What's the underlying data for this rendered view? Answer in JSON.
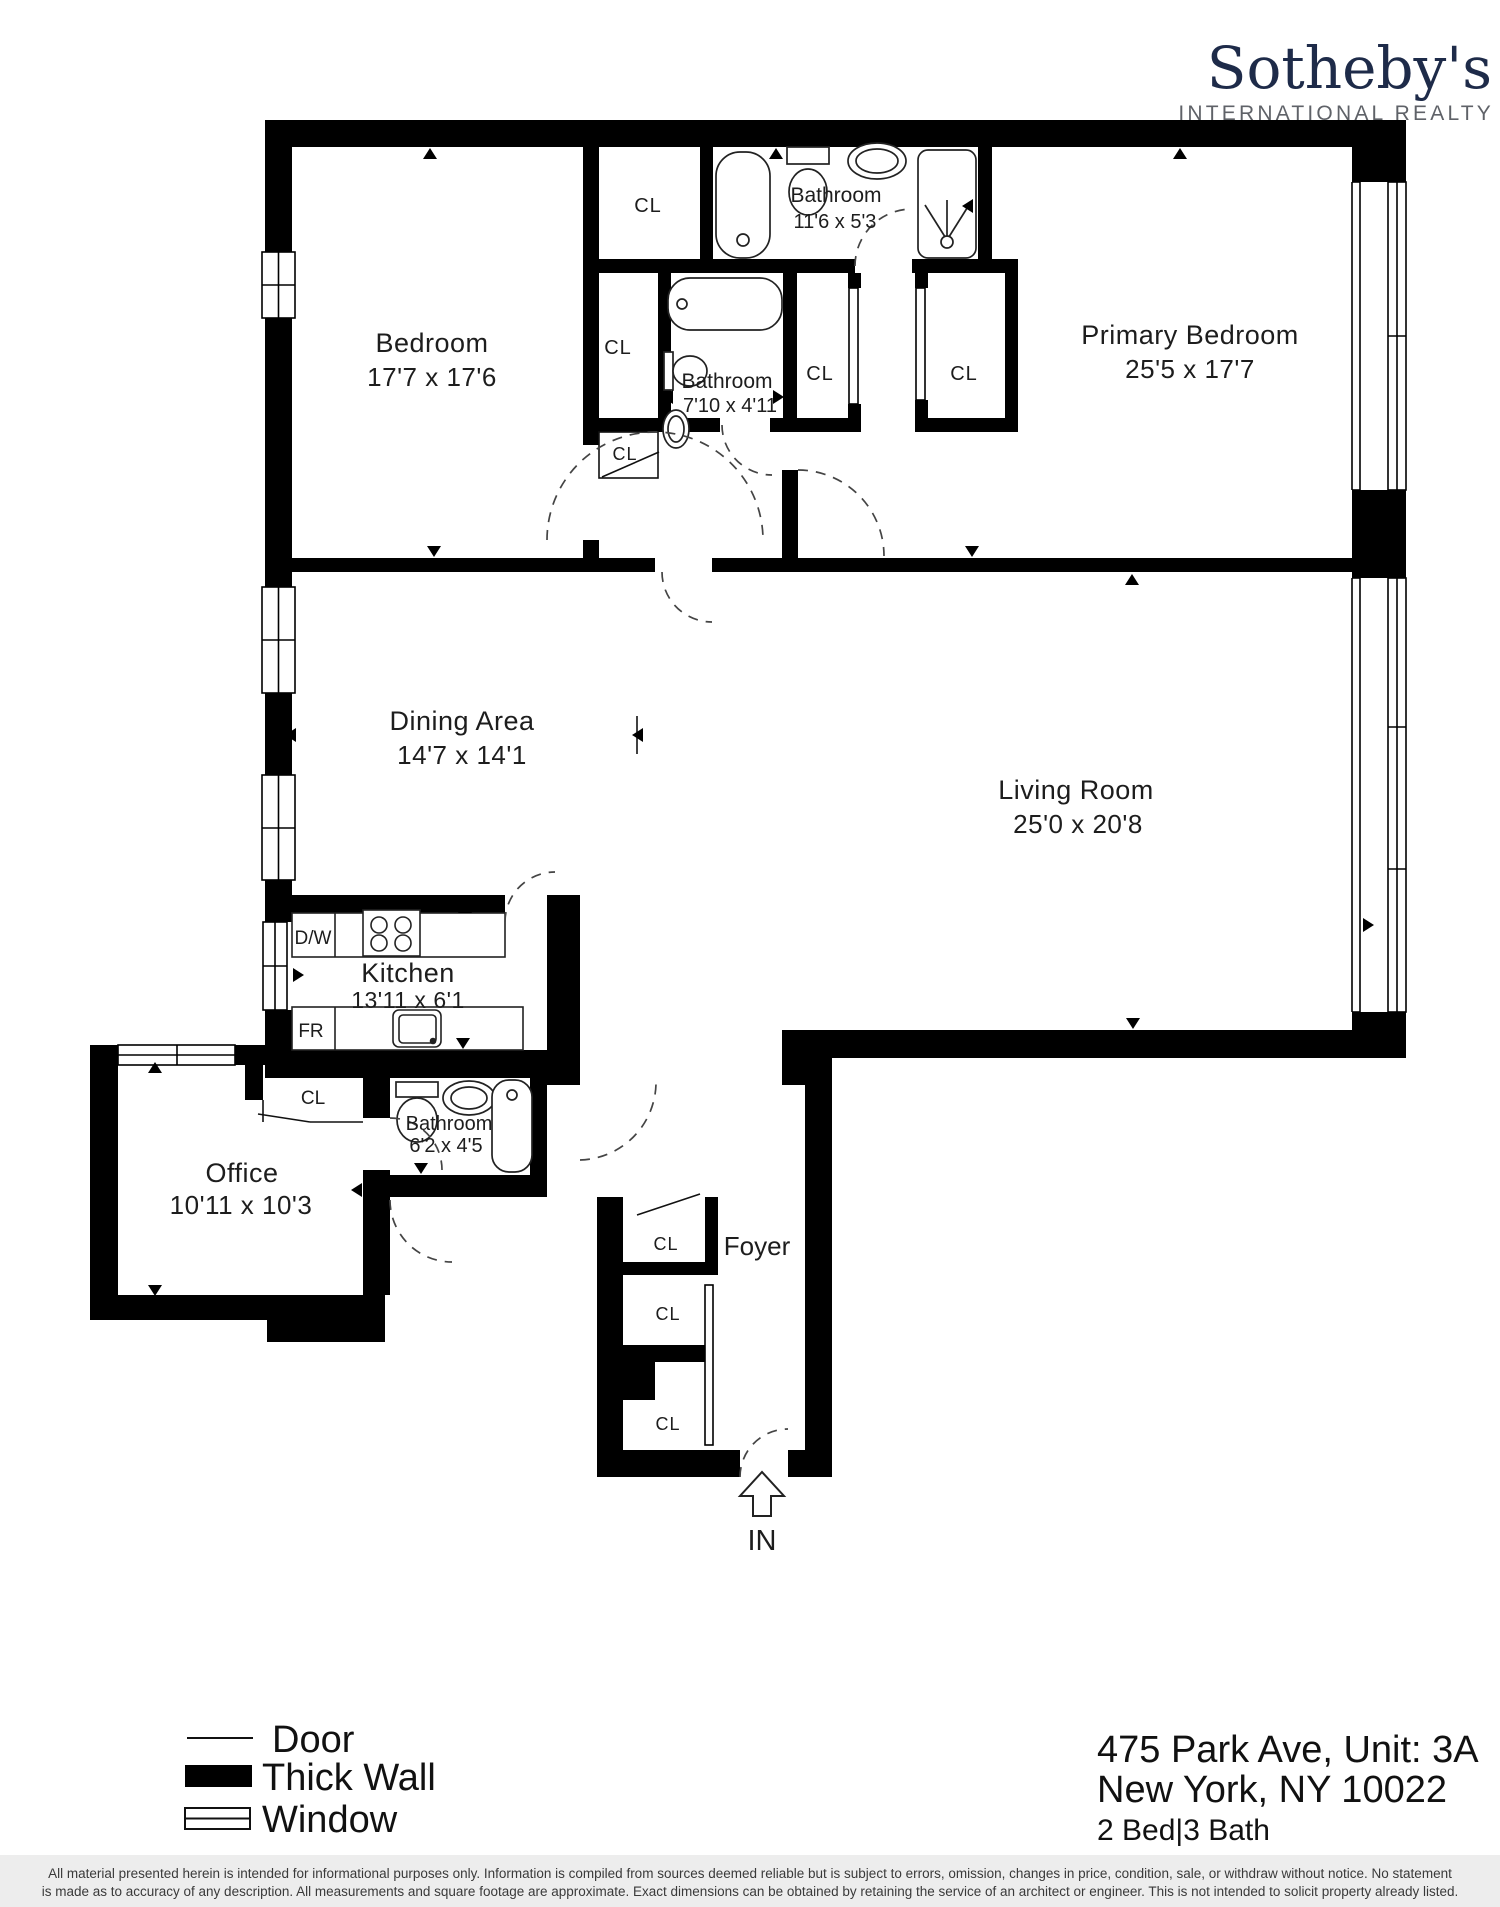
{
  "brand": {
    "name": "Sotheby's",
    "tagline": "INTERNATIONAL REALTY",
    "navy": "#1e2b49",
    "gray": "#5f6268"
  },
  "rooms": {
    "bedroom": {
      "name": "Bedroom",
      "dims": "17'7 x 17'6"
    },
    "bath1": {
      "name": "Bathroom",
      "dims": "11'6 x 5'3"
    },
    "primary": {
      "name": "Primary Bedroom",
      "dims": "25'5 x 17'7"
    },
    "bath2": {
      "name": "Bathroom",
      "dims": "7'10 x 4'11"
    },
    "dining": {
      "name": "Dining Area",
      "dims": "14'7 x 14'1"
    },
    "living": {
      "name": "Living Room",
      "dims": "25'0 x 20'8"
    },
    "kitchen": {
      "name": "Kitchen",
      "dims": "13'11 x 6'1"
    },
    "office": {
      "name": "Office",
      "dims": "10'11 x 10'3"
    },
    "bath3": {
      "name": "Bathroom",
      "dims": "6'2 x 4'5"
    },
    "foyer": {
      "name": "Foyer"
    }
  },
  "labels": {
    "closet": "CL",
    "dishwasher": "D/W",
    "fridge": "FR",
    "entry": "IN"
  },
  "legend": {
    "door": "Door",
    "thick_wall": "Thick Wall",
    "window": "Window"
  },
  "address": {
    "line1": "475 Park Ave, Unit: 3A",
    "line2": "New York, NY 10022",
    "meta": "2 Bed|3 Bath"
  },
  "disclaimer": {
    "line1": "All material presented herein is intended for informational purposes only. Information is compiled from sources deemed reliable but is subject to errors, omission, changes in price, condition, sale, or withdraw without notice. No statement",
    "line2": "is made as to accuracy of any description. All measurements and square footage are approximate. Exact dimensions can be obtained by retaining the service of an architect or engineer. This is not intended to solicit property already listed."
  }
}
